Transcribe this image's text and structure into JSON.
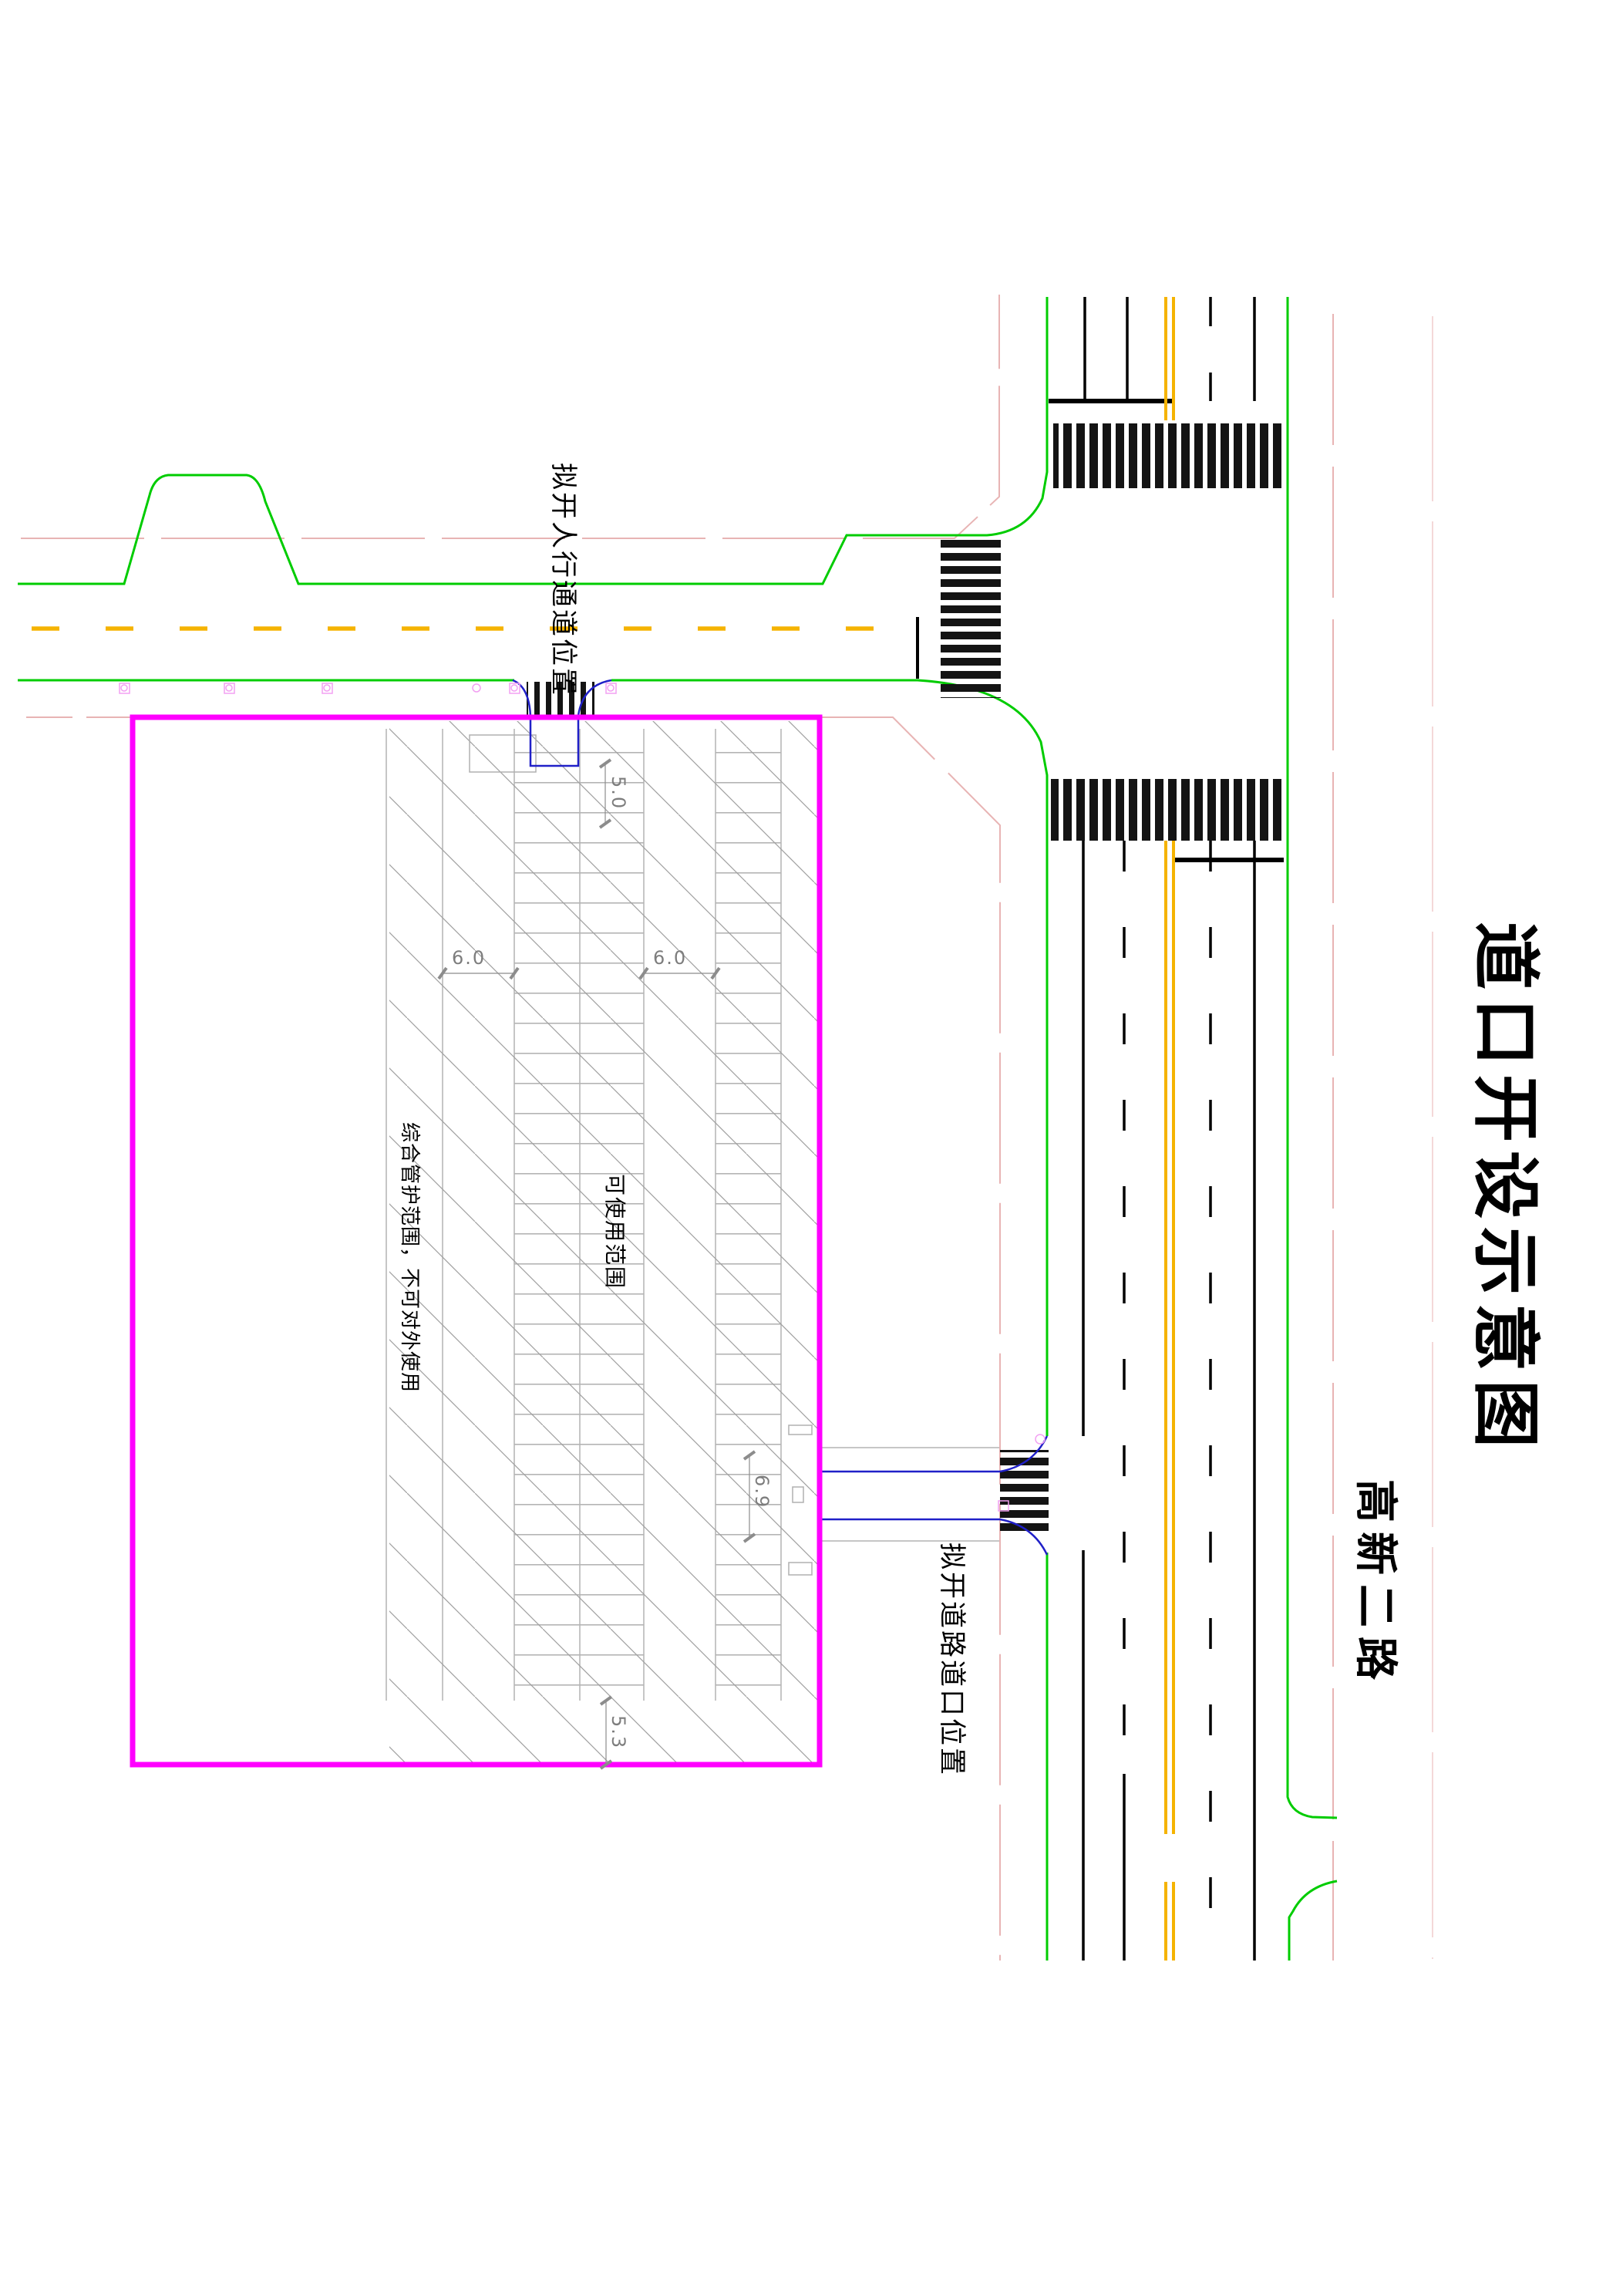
{
  "drawing": {
    "title": "道口开设示意图",
    "road_name": "高新二路",
    "labels": {
      "pedestrian_passage": "拟开人行通道位置",
      "road_opening": "拟开道路道口位置",
      "management_zone": "综合管护范围，不可对外使用",
      "usable_zone": "可使用范围"
    },
    "dimensions": {
      "passage_width": "5.0",
      "aisle_left": "6.0",
      "aisle_right": "6.0",
      "opening_width": "6.9",
      "bottom_offset": "5.3"
    },
    "colors": {
      "site_boundary": "#ff00ff",
      "curb_green": "#00cc00",
      "center_yellow": "#f5b301",
      "lane_black": "#000000",
      "redline_pink": "#e8b4b4",
      "utility_pink": "#f2a0f2",
      "passage_blue": "#2020c8",
      "grid_gray": "#b4b4b4",
      "hatch_gray": "#9a9a9a",
      "dim_gray": "#8c8c8c"
    }
  }
}
